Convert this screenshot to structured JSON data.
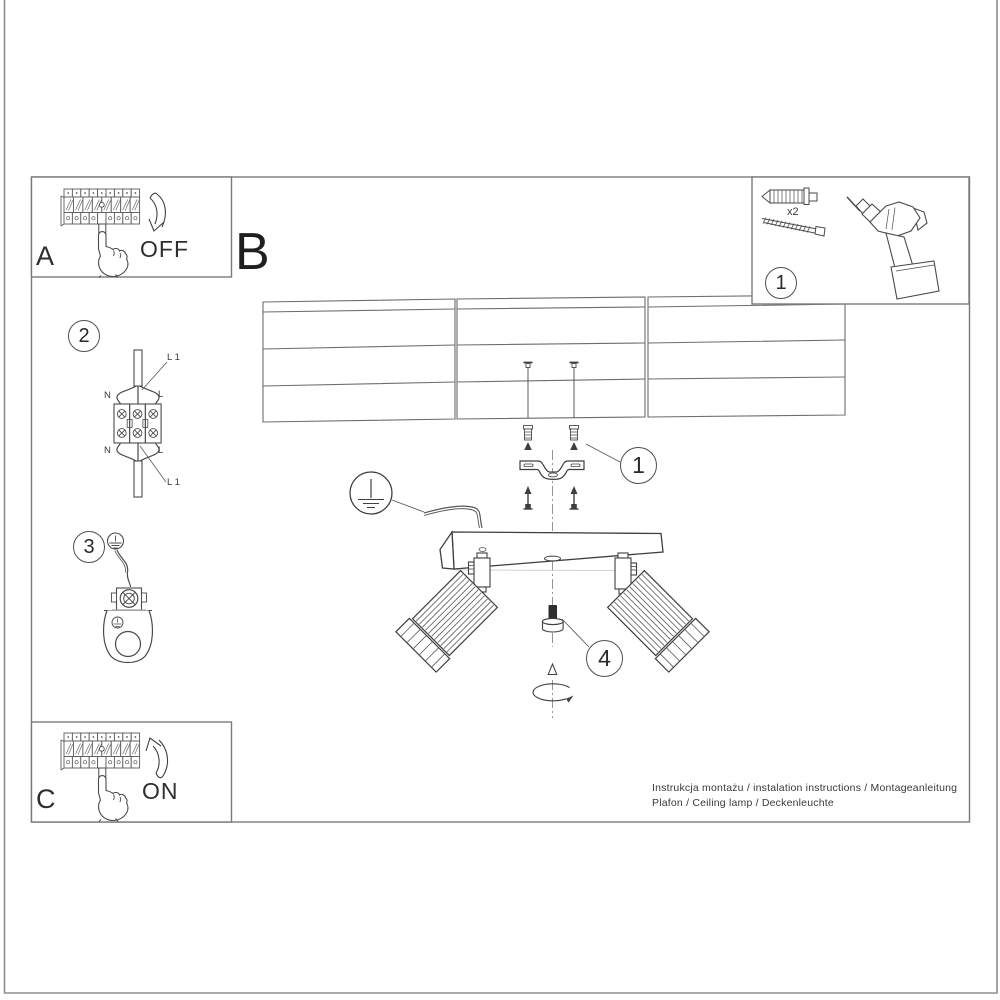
{
  "footer": {
    "line1": "Instrukcja montażu / instalation instructions / Montageanleitung",
    "line2": "Plafon / Ceiling lamp / Deckenleuchte"
  },
  "panels": {
    "power_off": {
      "letter": "A",
      "state_label": "OFF"
    },
    "section_b": {
      "letter": "B"
    },
    "power_on": {
      "letter": "C",
      "state_label": "ON"
    },
    "tools": {
      "step_badge": "1",
      "screw_count": "x2"
    }
  },
  "steps": {
    "wiring": {
      "badge": "2",
      "terminals": {
        "top_left": "N",
        "top_right": "L",
        "top_wire": "L 1",
        "bottom_left": "N",
        "bottom_right": "L",
        "bottom_wire": "L 1"
      }
    },
    "ground": {
      "badge": "3"
    },
    "anchors": {
      "badge": "1"
    },
    "adjust": {
      "badge": "4"
    }
  },
  "colors": {
    "ink": "#4a4a4a",
    "frame": "#808080",
    "paper": "#ffffff"
  }
}
